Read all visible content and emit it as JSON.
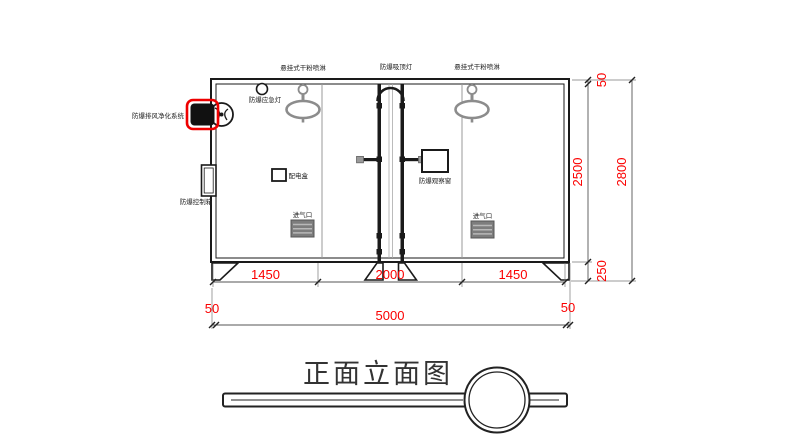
{
  "drawing": {
    "title": "正面立面图",
    "labels": {
      "sprinkler_left": "悬挂式干粉喷淋",
      "ceiling_light": "防爆吸顶灯",
      "sprinkler_right": "悬挂式干粉喷淋",
      "emergency_light": "防爆应急灯",
      "exhaust_purifier": "防爆排风净化系统",
      "control_box": "防爆控制箱",
      "distribution_box": "配电盒",
      "observation_window": "防爆观察窗",
      "air_inlet_left": "进气口",
      "air_inlet_right": "进气口"
    },
    "dimensions": {
      "bottom_sections": [
        "1450",
        "2000",
        "1450"
      ],
      "bottom_total": {
        "left_margin": "50",
        "width": "5000",
        "right_margin": "50"
      },
      "right_inner": {
        "top": "50",
        "body_height": "2500",
        "base_height": "250"
      },
      "right_total": "2800"
    },
    "colors": {
      "dimension_text": "#fb0000",
      "highlight_box": "#ee0000",
      "linework": "#1a1a1a",
      "secondary_linework": "#8c8c8c"
    }
  }
}
